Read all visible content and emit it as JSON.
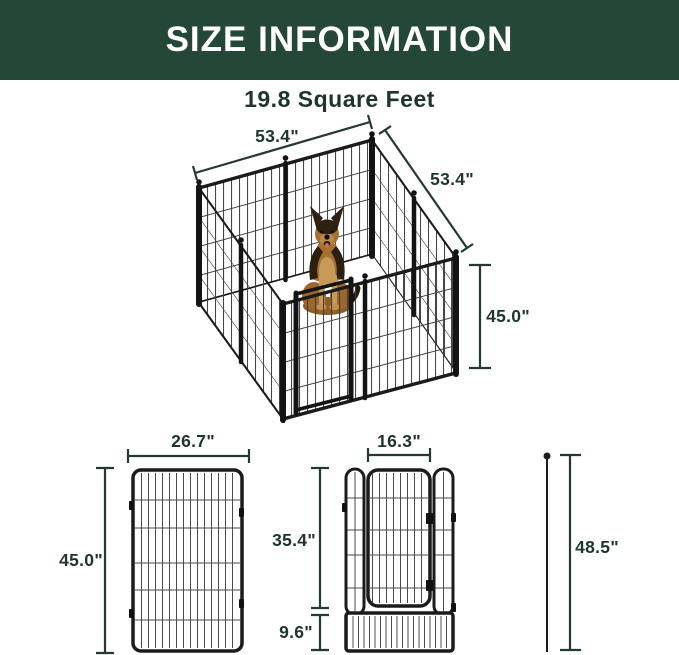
{
  "header": {
    "title": "SIZE INFORMATION",
    "subtitle": "19.8 Square Feet"
  },
  "playpen_diagram": {
    "top_width_label": "53.4\"",
    "side_depth_label": "53.4\"",
    "height_label": "45.0\"",
    "illustration": "german-shepherd-dog-sitting-inside-pen"
  },
  "single_panel_diagram": {
    "width_label": "26.7\"",
    "height_label": "45.0\""
  },
  "door_panel_diagram": {
    "door_width_label": "16.3\"",
    "upper_height_label": "35.4\"",
    "bottom_height_label": "9.6\""
  },
  "stake_diagram": {
    "height_label": "48.5\""
  },
  "colors": {
    "banner_green": "#254737",
    "dark_text": "#1e352b",
    "dimension_line": "#24392f",
    "frame_black": "#1b1b1b"
  }
}
